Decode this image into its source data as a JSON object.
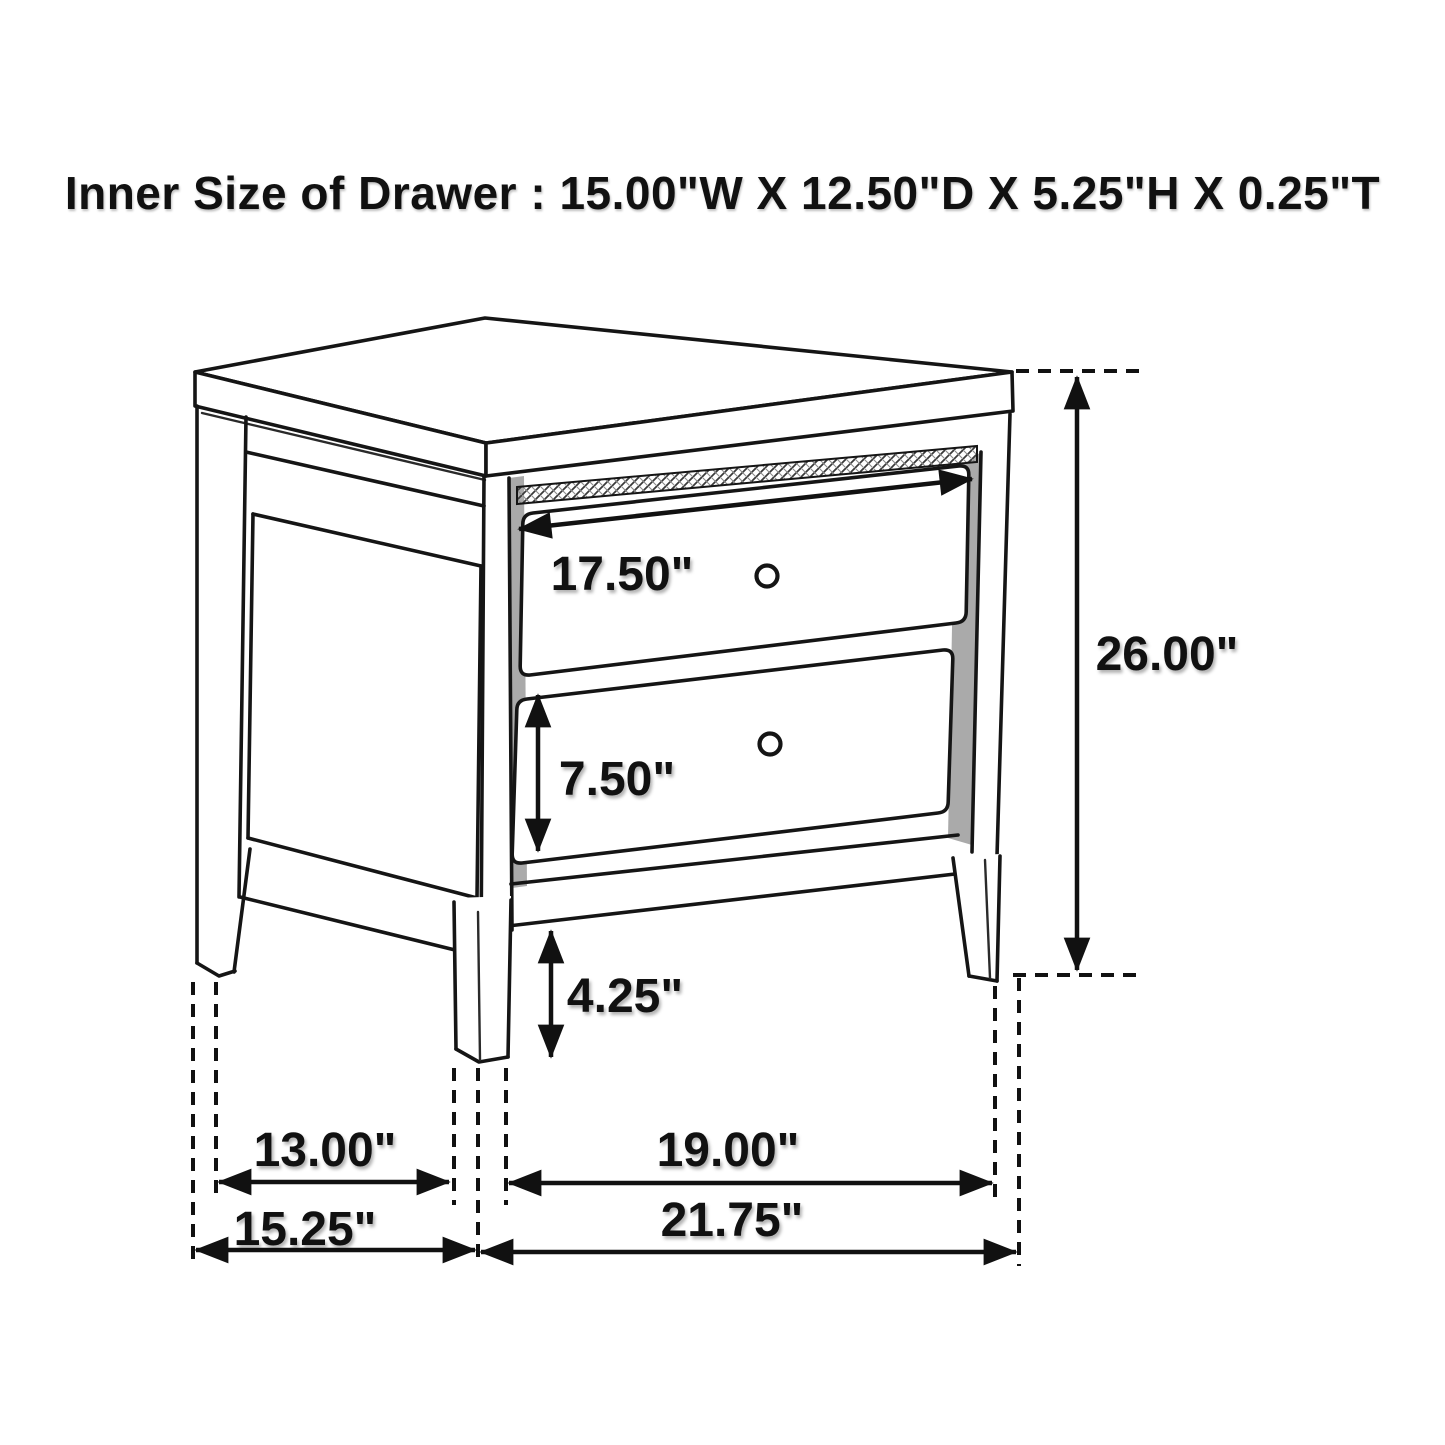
{
  "title": "Inner Size of Drawer : 15.00\"W X 12.50\"D X 5.25\"H X 0.25\"T",
  "inner_drawer_size": {
    "width": "15.00\"W",
    "depth": "12.50\"D",
    "height": "5.25\"H",
    "thickness": "0.25\"T"
  },
  "dimension_labels": {
    "drawer_front_width": "17.50\"",
    "overall_height": "26.00\"",
    "lower_drawer_height": "7.50\"",
    "floor_clearance": "4.25\"",
    "depth_between_legs": "13.00\"",
    "overall_depth": "15.25\"",
    "width_between_legs": "19.00\"",
    "overall_width": "21.75\""
  },
  "colors": {
    "line": "#111111",
    "shadow_gray": "#9b9b9b",
    "background": "#ffffff"
  }
}
